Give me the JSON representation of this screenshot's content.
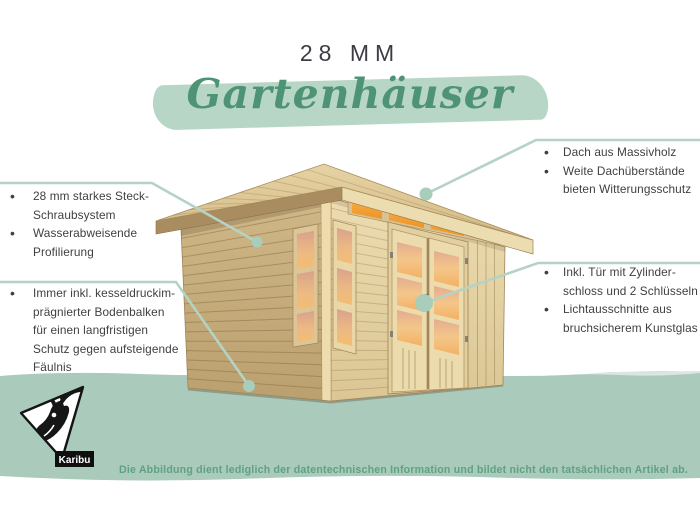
{
  "header": {
    "size_label": "28 MM",
    "script_title": "Gartenhäuser"
  },
  "callouts": {
    "left_top": [
      [
        "28 mm starkes Steck-",
        "Schraubsystem"
      ],
      [
        "Wasserabweisende",
        "Profilierung"
      ]
    ],
    "left_bottom": [
      [
        "Immer inkl. kesseldruckim-",
        "prägnierter Bodenbalken",
        "für einen langfristigen",
        "Schutz gegen aufsteigende",
        "Fäulnis"
      ]
    ],
    "right_top": [
      [
        "Dach aus Massivholz"
      ],
      [
        "Weite Dachüberstände",
        "bieten Witterungsschutz"
      ]
    ],
    "right_middle": [
      [
        "Inkl. Tür mit Zylinder-",
        "schloss und 2 Schlüsseln"
      ],
      [
        "Lichtausschnitte aus",
        "bruchsicherem Kunstglas"
      ]
    ]
  },
  "footer": {
    "disclaimer": "Die Abbildung dient lediglich der datentechnischen Information und bildet nicht den tatsächlichen Artikel ab.",
    "brand": "Karibu"
  },
  "colors": {
    "script_green": "#4f9376",
    "brush_green": "#b7d6c6",
    "band_green": "#aacabb",
    "callout_line_green": "#b4d3c4",
    "text_dark": "#3f3f44",
    "disclaimer_green": "#5fa183"
  }
}
